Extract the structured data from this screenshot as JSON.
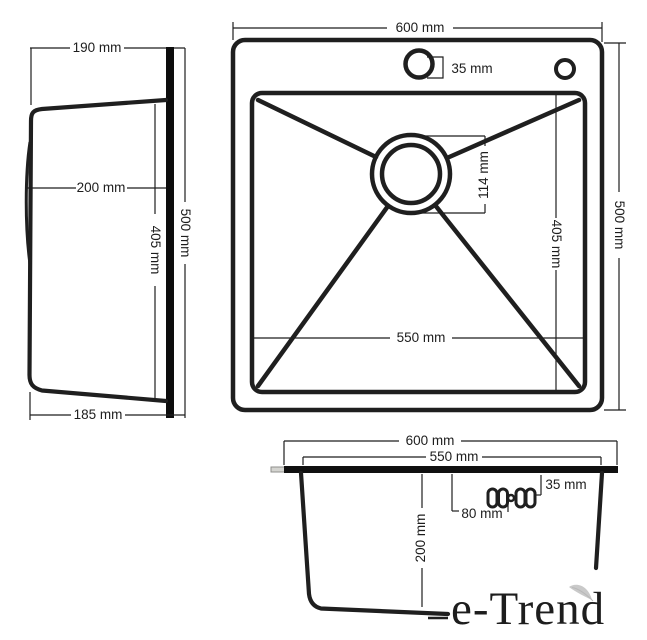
{
  "colors": {
    "line": "#1f1f1f",
    "background": "#ffffff",
    "tab_fill": "#d4d4d0",
    "leaf": "#c9c9c9"
  },
  "side_view": {
    "top_width": "190 mm",
    "depth": "200 mm",
    "inner_height": "405 mm",
    "overall_height": "500 mm",
    "bottom_width": "185 mm"
  },
  "top_view": {
    "overall_width": "600 mm",
    "faucet_hole": "35 mm",
    "drain_diameter": "114 mm",
    "bowl_length": "550 mm",
    "bowl_height": "405 mm",
    "overall_height": "500 mm"
  },
  "section_view": {
    "overall_width": "600 mm",
    "bowl_width": "550 mm",
    "edge_offset": "35 mm",
    "hole_offset": "80 mm",
    "bowl_depth": "200 mm"
  },
  "logo": {
    "text": "e-Trend",
    "gradient_start": "#0f6b38",
    "gradient_end": "#90c83d"
  }
}
